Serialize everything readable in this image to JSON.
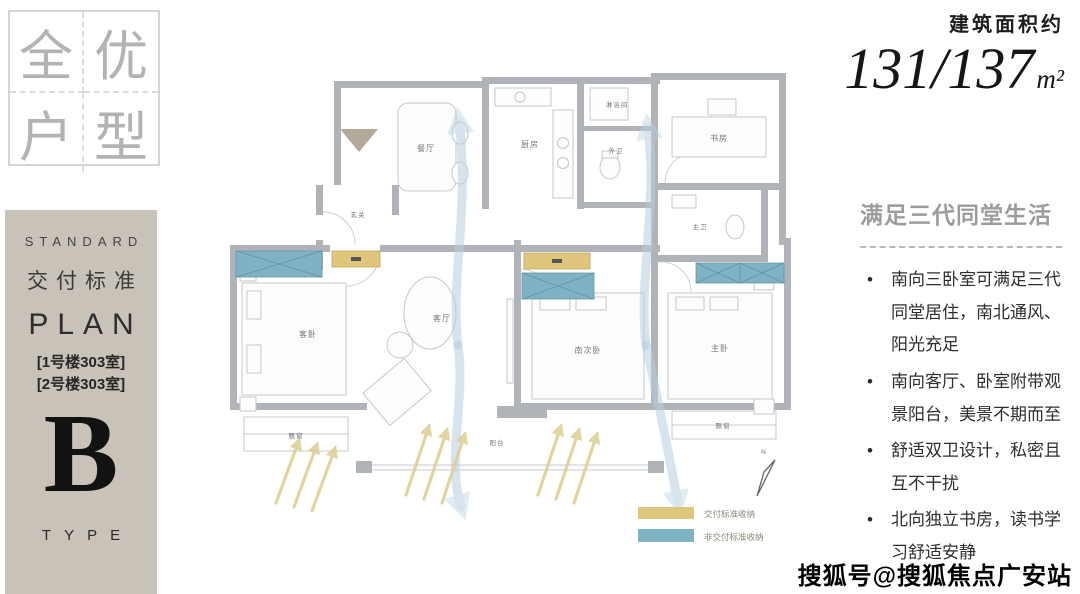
{
  "colors": {
    "panel_tan": "#c8c2b9",
    "badge_gray": "#b3b3b3",
    "wall_gray": "#b0b4b8",
    "storage_yellow": "#dfc67c",
    "storage_blue": "#7fb3c3",
    "airflow_blue": "#b7cfdf",
    "sun_yellow": "#ddd096",
    "heading_gray": "#9c9c9c",
    "text_dark": "#2e2e2e"
  },
  "badge": {
    "chars": [
      "全",
      "优",
      "户",
      "型"
    ]
  },
  "left_panel": {
    "standard_label": "STANDARD",
    "delivery_label": "交付标准",
    "plan_label": "PLAN",
    "unit_lines": [
      "[1号楼303室]",
      "[2号楼303室]"
    ],
    "type_letter": "B",
    "type_label": "TYPE"
  },
  "area": {
    "label": "建筑面积约",
    "value": "131/137",
    "unit": "m²"
  },
  "right_panel": {
    "heading": "满足三代同堂生活",
    "bullets": [
      "南向三卧室可满足三代同堂居住，南北通风、阳光充足",
      "南向客厅、卧室附带观景阳台，美景不期而至",
      "舒适双卫设计，私密且互不干扰",
      "北向独立书房，读书学习舒适安静"
    ]
  },
  "floor_plan": {
    "rooms": {
      "entrance": "玄关",
      "dining": "餐厅",
      "kitchen": "厨房",
      "shower": "淋浴间",
      "guest_bath": "外卫",
      "study": "书房",
      "master_bath": "主卫",
      "guest_bedroom": "客卧",
      "living": "客厅",
      "south_bedroom": "南次卧",
      "master_bedroom": "主卧",
      "balcony": "阳台"
    },
    "bay_window_label": "飘窗",
    "compass_label": "N",
    "legend": [
      {
        "label": "交付标准收纳",
        "color": "#dfc67c"
      },
      {
        "label": "非交付标准收纳",
        "color": "#7fb3c3"
      }
    ]
  },
  "watermark": "搜狐号@搜狐焦点广安站"
}
